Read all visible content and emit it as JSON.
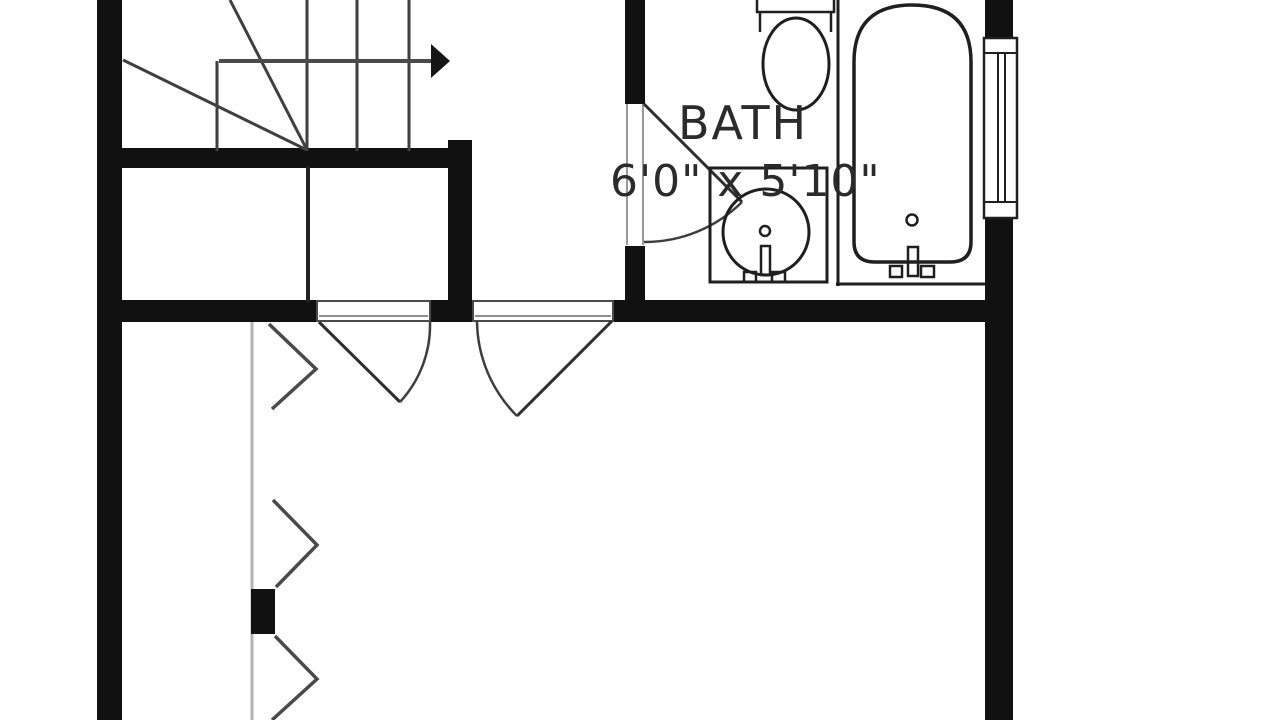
{
  "plan": {
    "room_label": "BATH",
    "room_dimensions": "6'0\" x 5'10\""
  },
  "colors": {
    "background": "#ffffff",
    "wall": "#111111",
    "fixture_line": "#1f1f1f",
    "stair_line": "#3f3f3f",
    "door_arc": "#3e3e3e",
    "door_jamb": "#9a9a9a",
    "closet_track": "#b3b3b3",
    "label_text": "#2b2b2b"
  },
  "fixtures": [
    "winder-staircase-with-up-arrow",
    "bath-swing-door",
    "toilet",
    "sink-vanity",
    "bathtub",
    "double-hung-window",
    "interior-swing-door-left",
    "interior-swing-door-right",
    "bifold-closet-doors"
  ]
}
